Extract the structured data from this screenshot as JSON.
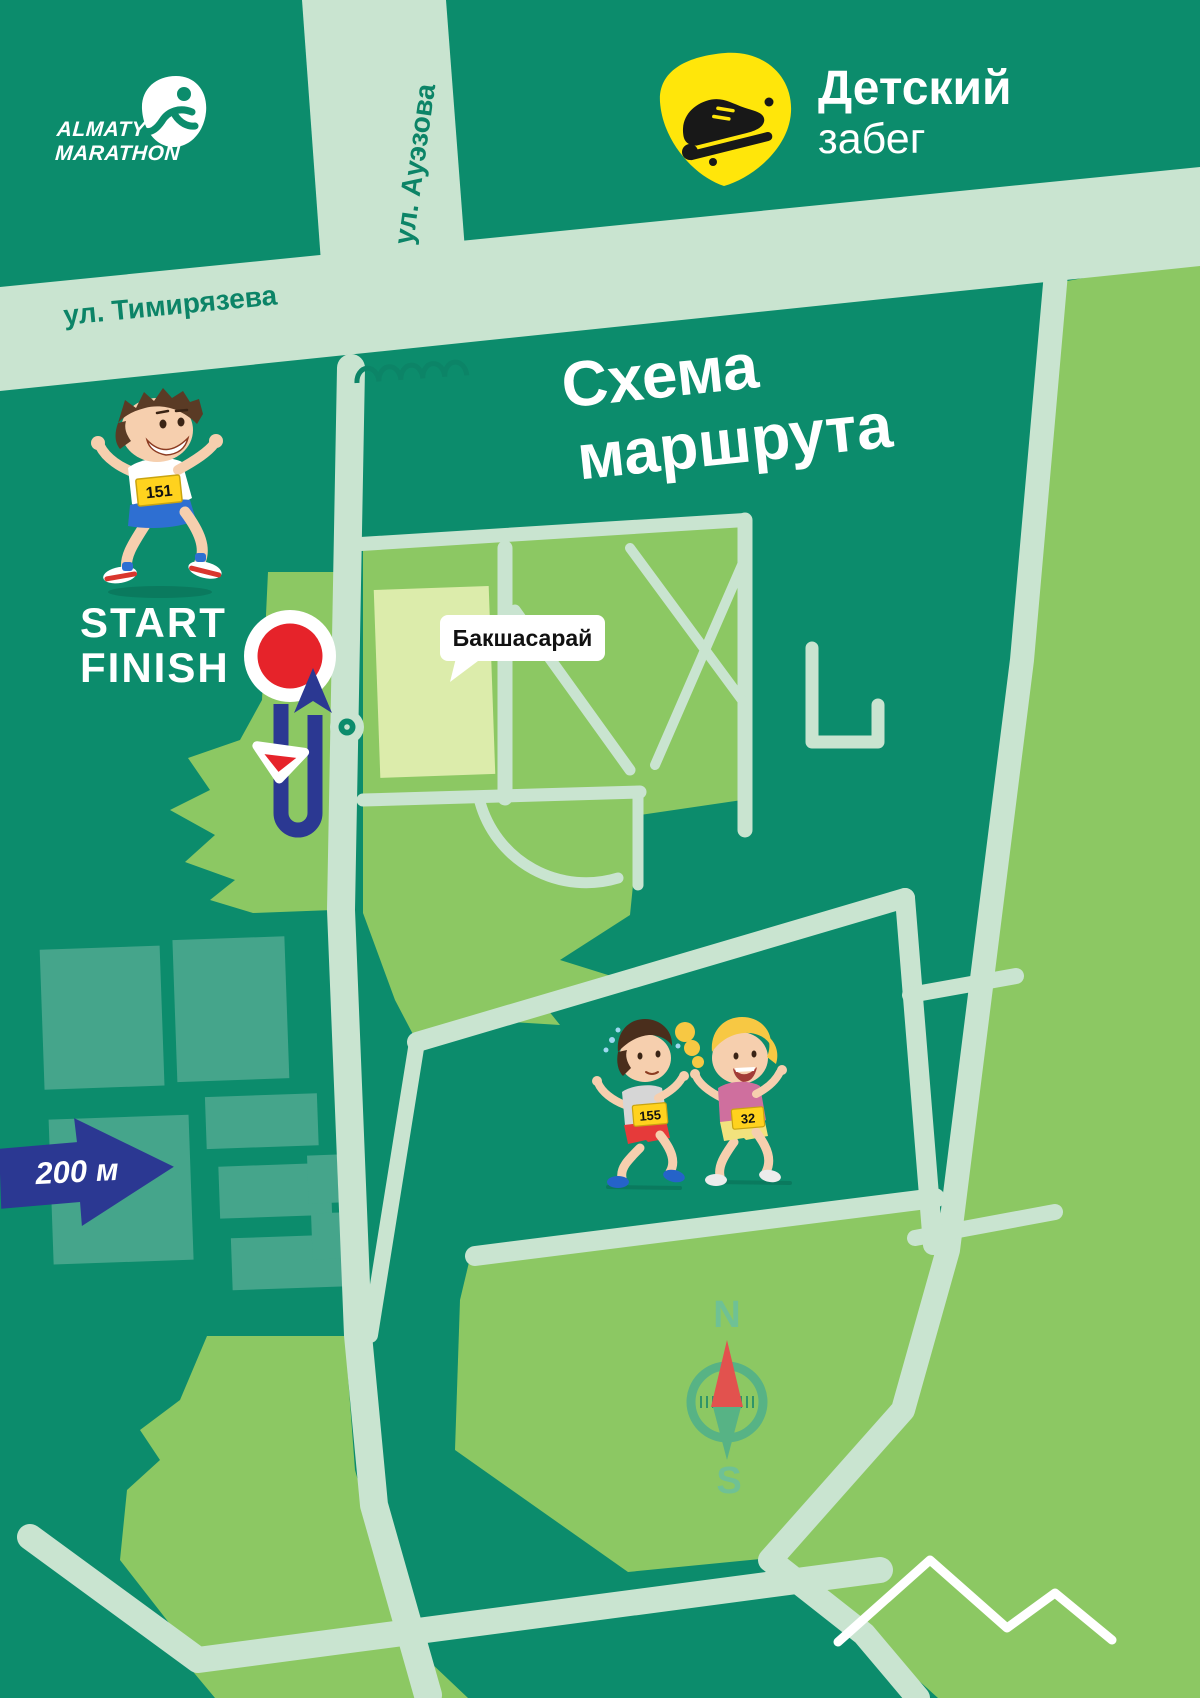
{
  "header": {
    "logo": {
      "line1": "ALMATY",
      "line2": "MARATHON"
    },
    "event": {
      "line1": "Детский",
      "line2": "забег"
    }
  },
  "map_title": {
    "line1": "Схема",
    "line2": "маршрута"
  },
  "streets": {
    "timiryazeva": "ул. Тимирязева",
    "auezova": "ул. Ауэзова"
  },
  "poi": {
    "bakshasaray": "Бакшасарай"
  },
  "markers": {
    "start": "START",
    "finish": "FINISH",
    "scale": "200 м"
  },
  "compass": {
    "north": "N",
    "south": "S"
  },
  "runners": [
    {
      "bib": "151"
    },
    {
      "bib": "155"
    },
    {
      "bib": "32"
    }
  ],
  "colors": {
    "background": "#0c8c6c",
    "street": "#c9e4d0",
    "park": "#8cc863",
    "field": "#dcecab",
    "building": "#45a58b",
    "route_blue": "#2b3892",
    "marker_red": "#e6232a",
    "badge_yellow": "#ffe60a",
    "bib_yellow": "#ffd21e",
    "compass_green": "#57b385",
    "label_green": "#0c8467",
    "white": "#ffffff"
  }
}
